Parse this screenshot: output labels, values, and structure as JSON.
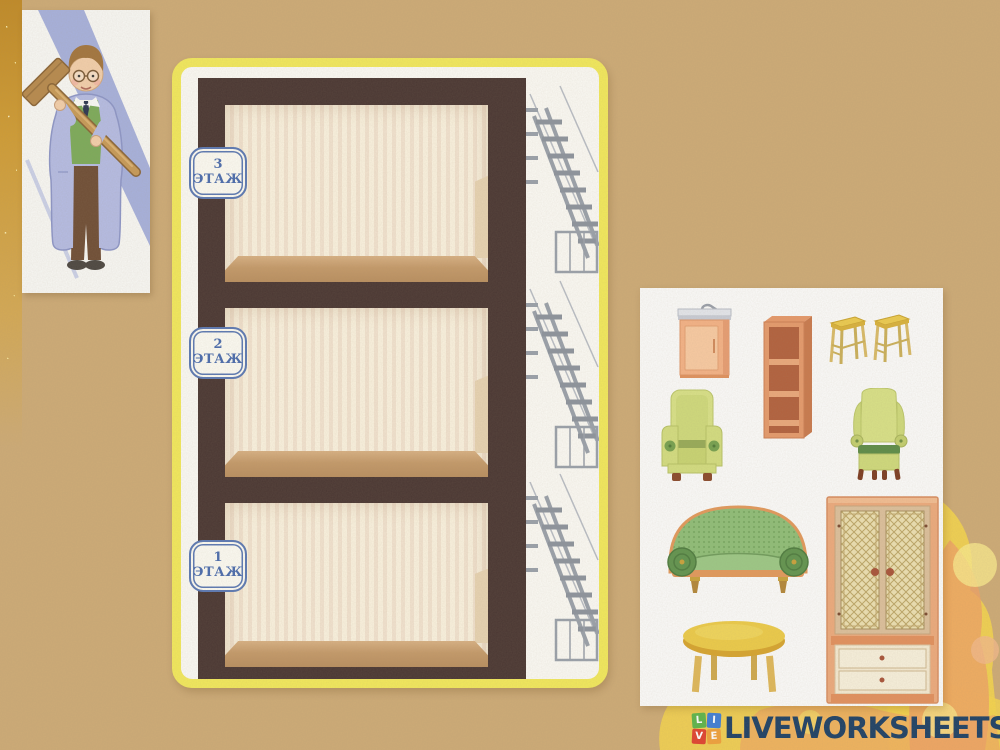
{
  "palette": {
    "paper": "#cdab77",
    "card_border_yellow": "#f2e95c",
    "card_white": "#fbfaf5",
    "frame_brown": "#4a3733",
    "wallpaper_cream": "#faf2df",
    "wallpaper_pink": "#f2e3d0",
    "floor_tan": "#c49a6a",
    "escape_gray": "#9aa1ab",
    "badge_blue": "#4a6cae",
    "panel_white": "#fbfbfa",
    "gold": "#d4a83e",
    "splash_yellow": "#f4d44e",
    "splash_orange": "#efa265"
  },
  "building": {
    "floors": [
      {
        "number": "3",
        "word": "ЭТАЖ"
      },
      {
        "number": "2",
        "word": "ЭТАЖ"
      },
      {
        "number": "1",
        "word": "ЭТАЖ"
      }
    ]
  },
  "furniture": {
    "items": [
      {
        "icon": "sink-cabinet-icon"
      },
      {
        "icon": "open-shelf-icon"
      },
      {
        "icon": "stools-icon"
      },
      {
        "icon": "armchair-icon"
      },
      {
        "icon": "wingback-armchair-icon"
      },
      {
        "icon": "sofa-icon"
      },
      {
        "icon": "wardrobe-icon"
      },
      {
        "icon": "round-table-icon"
      }
    ]
  },
  "character": {
    "icon": "builder-with-mallet-illustration"
  },
  "branding": {
    "tiles": [
      {
        "letter": "L",
        "color": "#5db54b"
      },
      {
        "letter": "I",
        "color": "#3f7ed6"
      },
      {
        "letter": "V",
        "color": "#e04330"
      },
      {
        "letter": "E",
        "color": "#f0a13c"
      }
    ],
    "wordmark": "LIVEWORKSHEETS",
    "wordmark_color": "#1e4166"
  }
}
